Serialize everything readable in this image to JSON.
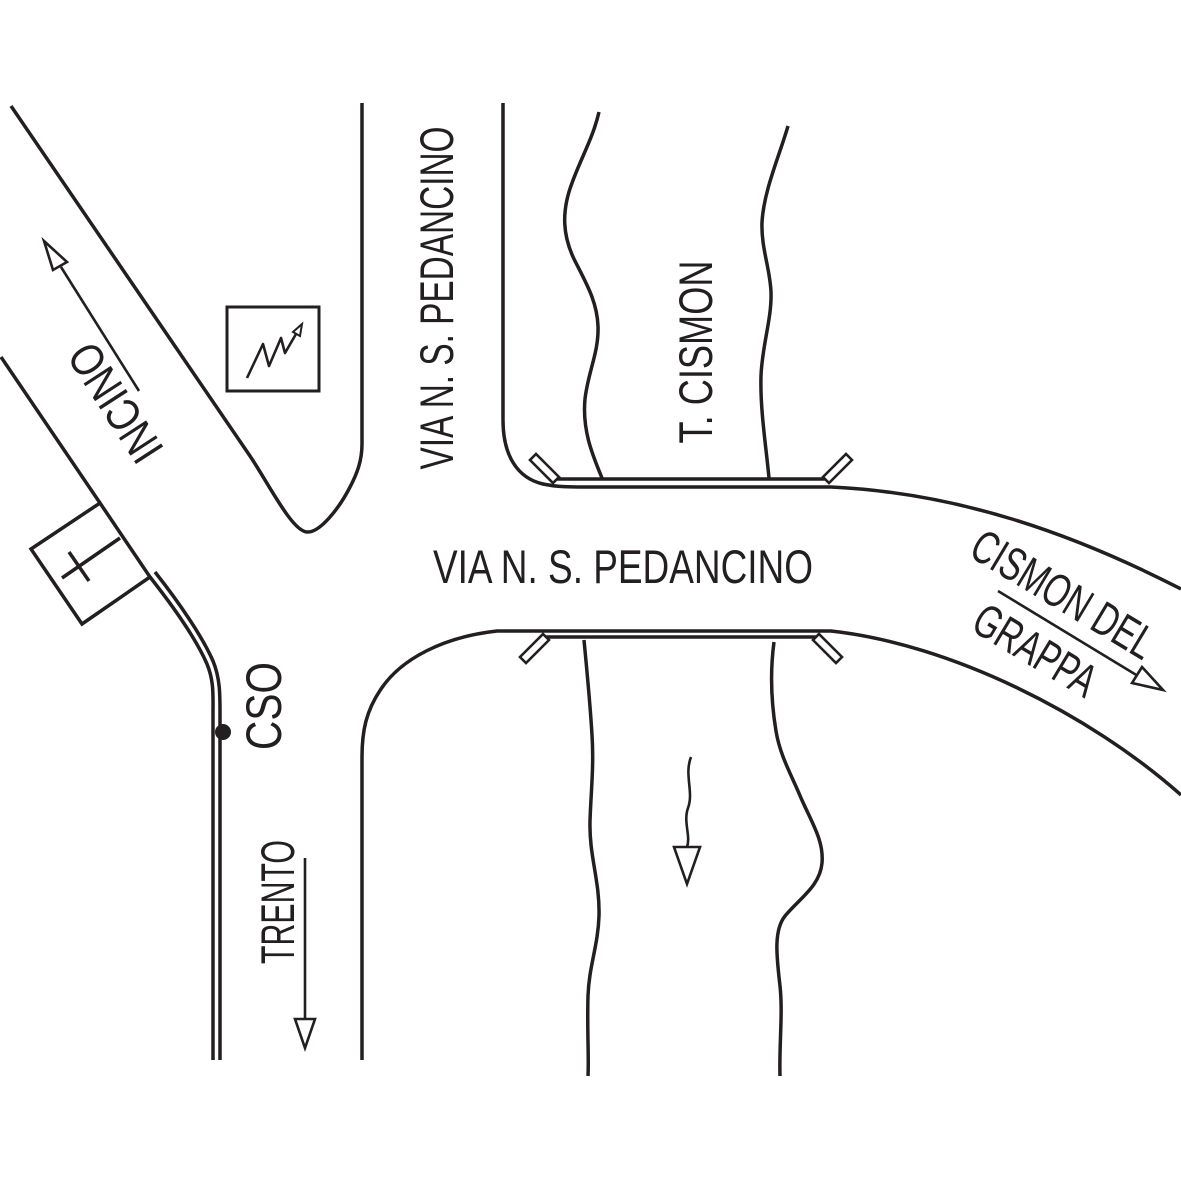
{
  "map": {
    "colors": {
      "ink": "#231f20",
      "background": "#ffffff"
    },
    "roads": {
      "label_horizontal": "VIA N. S. PEDANCINO",
      "label_vertical": "VIA N. S. PEDANCINO"
    },
    "river": {
      "label": "T. CISMON"
    },
    "destinations": {
      "northwest": "INCINO",
      "east_line1": "CISMON DEL",
      "east_line2": "GRAPPA",
      "south": "TRENTO"
    },
    "marker": {
      "label": "CSO"
    }
  }
}
